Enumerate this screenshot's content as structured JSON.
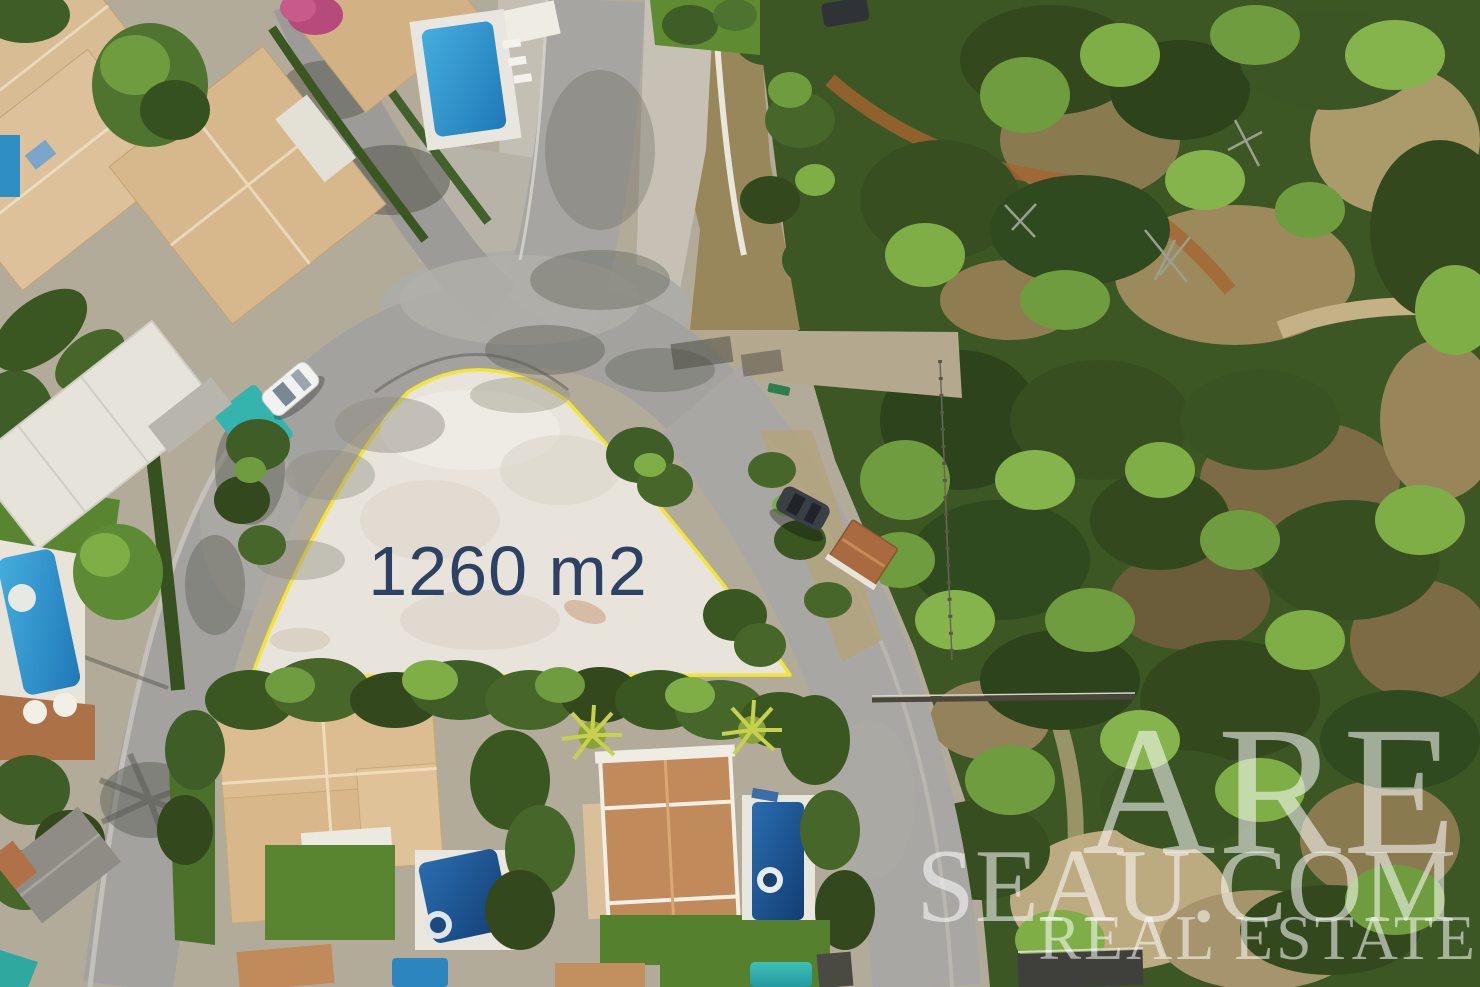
{
  "plot": {
    "area_label": "1260 m2",
    "label_color": "#2d4164",
    "outline_color": "#f2e535",
    "fill_color": "#ece8e1"
  },
  "watermark": {
    "line1": "ARE",
    "line2": "SEAU.COM",
    "line3": "REAL ESTATE",
    "color": "#ffffff"
  },
  "palette": {
    "road_asphalt": "#a3a29e",
    "roof_pale_tan": "#dcc19a",
    "roof_terracotta": "#c08a5a",
    "pool_bright_blue": "#2b86c0",
    "pool_dark_blue": "#123d72",
    "pool_teal": "#34b4ac",
    "forest_green": "#3c5724",
    "lawn_green": "#5a8530",
    "dirt_tan": "#b4a98f"
  }
}
